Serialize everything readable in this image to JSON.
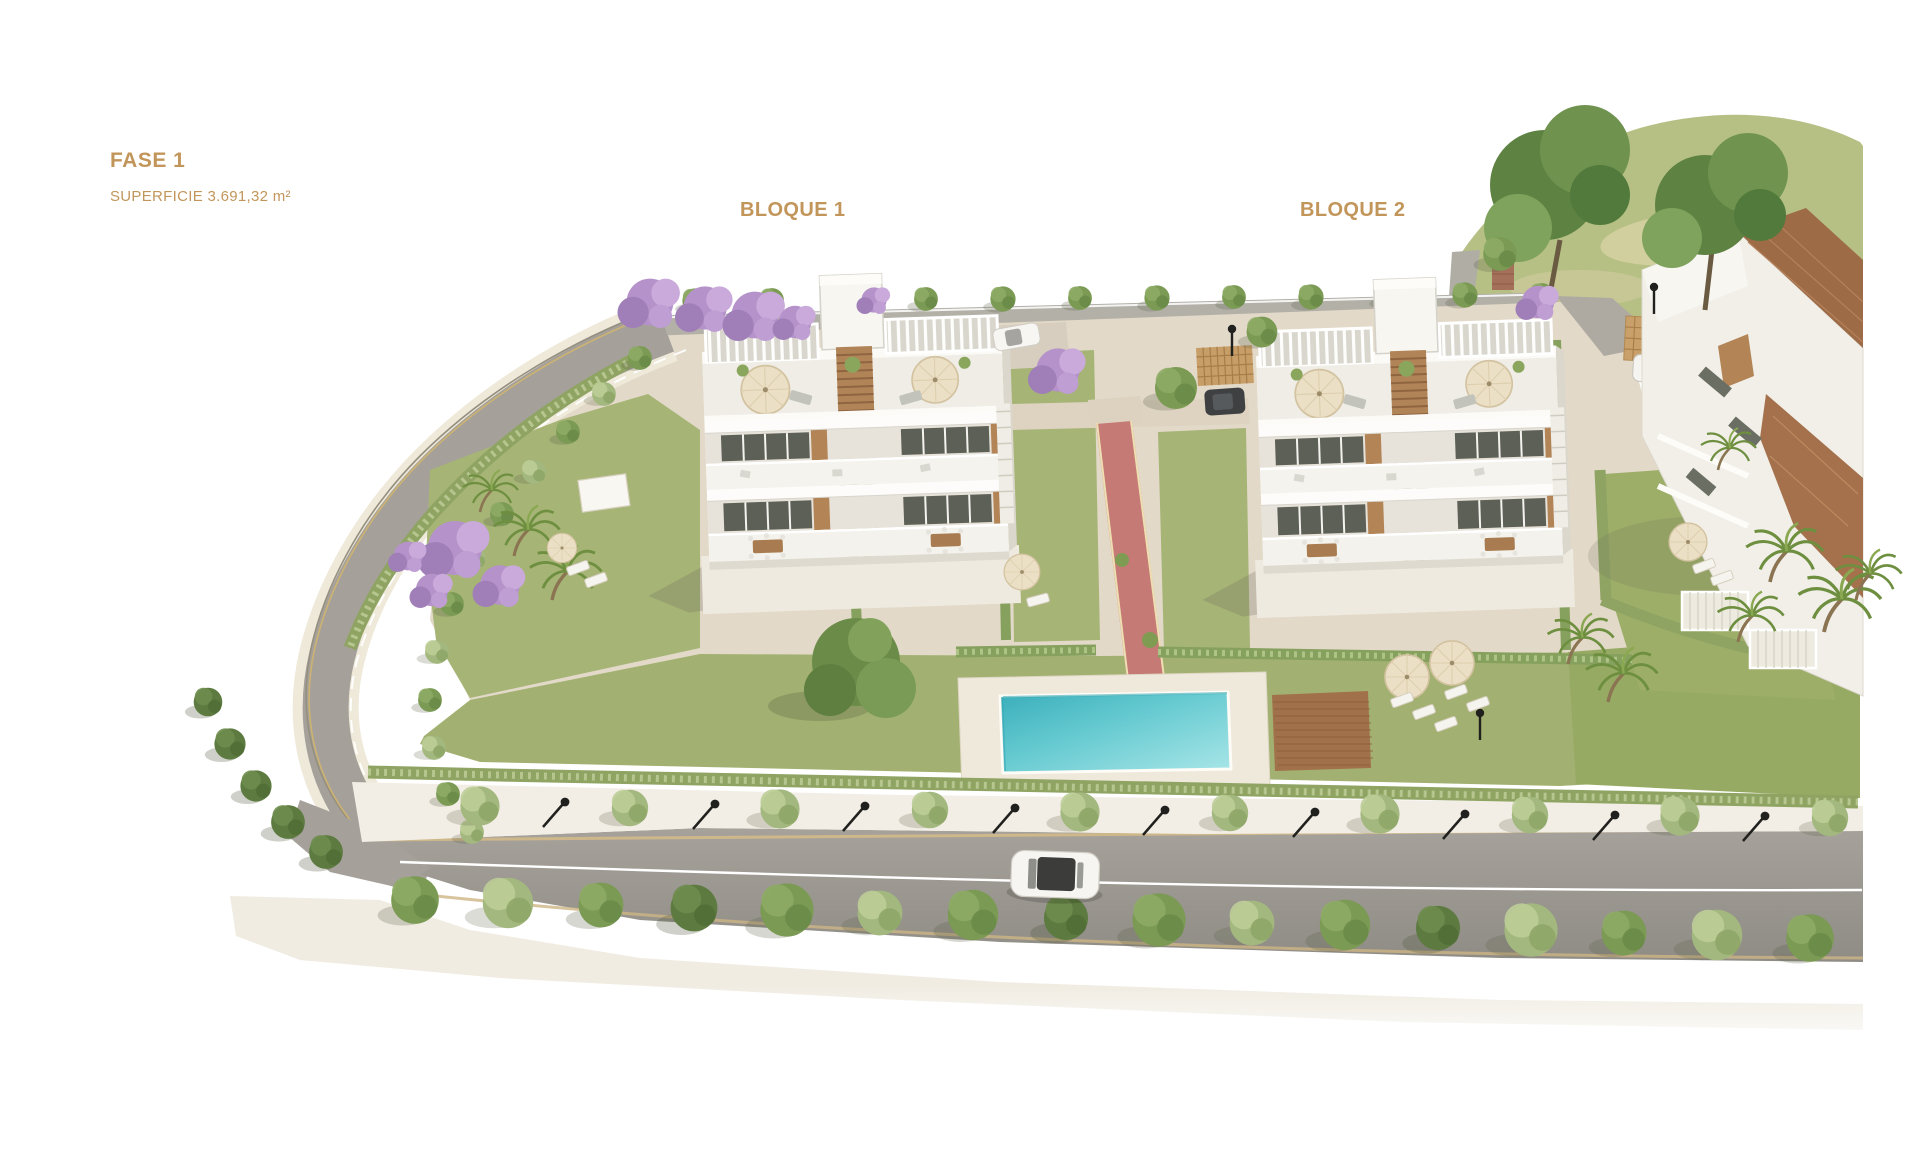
{
  "theme": {
    "background": "#ffffff",
    "accent_color": "#c2965a",
    "pool_water_color": "#6fcdd3",
    "lawn_color": "#a4b274",
    "road_color": "#9d9992",
    "pavement_color": "#e3dac9",
    "building_color": "#f3f2ed",
    "wood_color": "#b18458",
    "red_path_color": "#c77a74",
    "jacaranda_color": "#b795cb"
  },
  "annotations": {
    "phase_title": "FASE 1",
    "phase_surface": "SUPERFICIE 3.691,32 m²",
    "block1_label": "BLOQUE 1",
    "block2_label": "BLOQUE 2"
  }
}
